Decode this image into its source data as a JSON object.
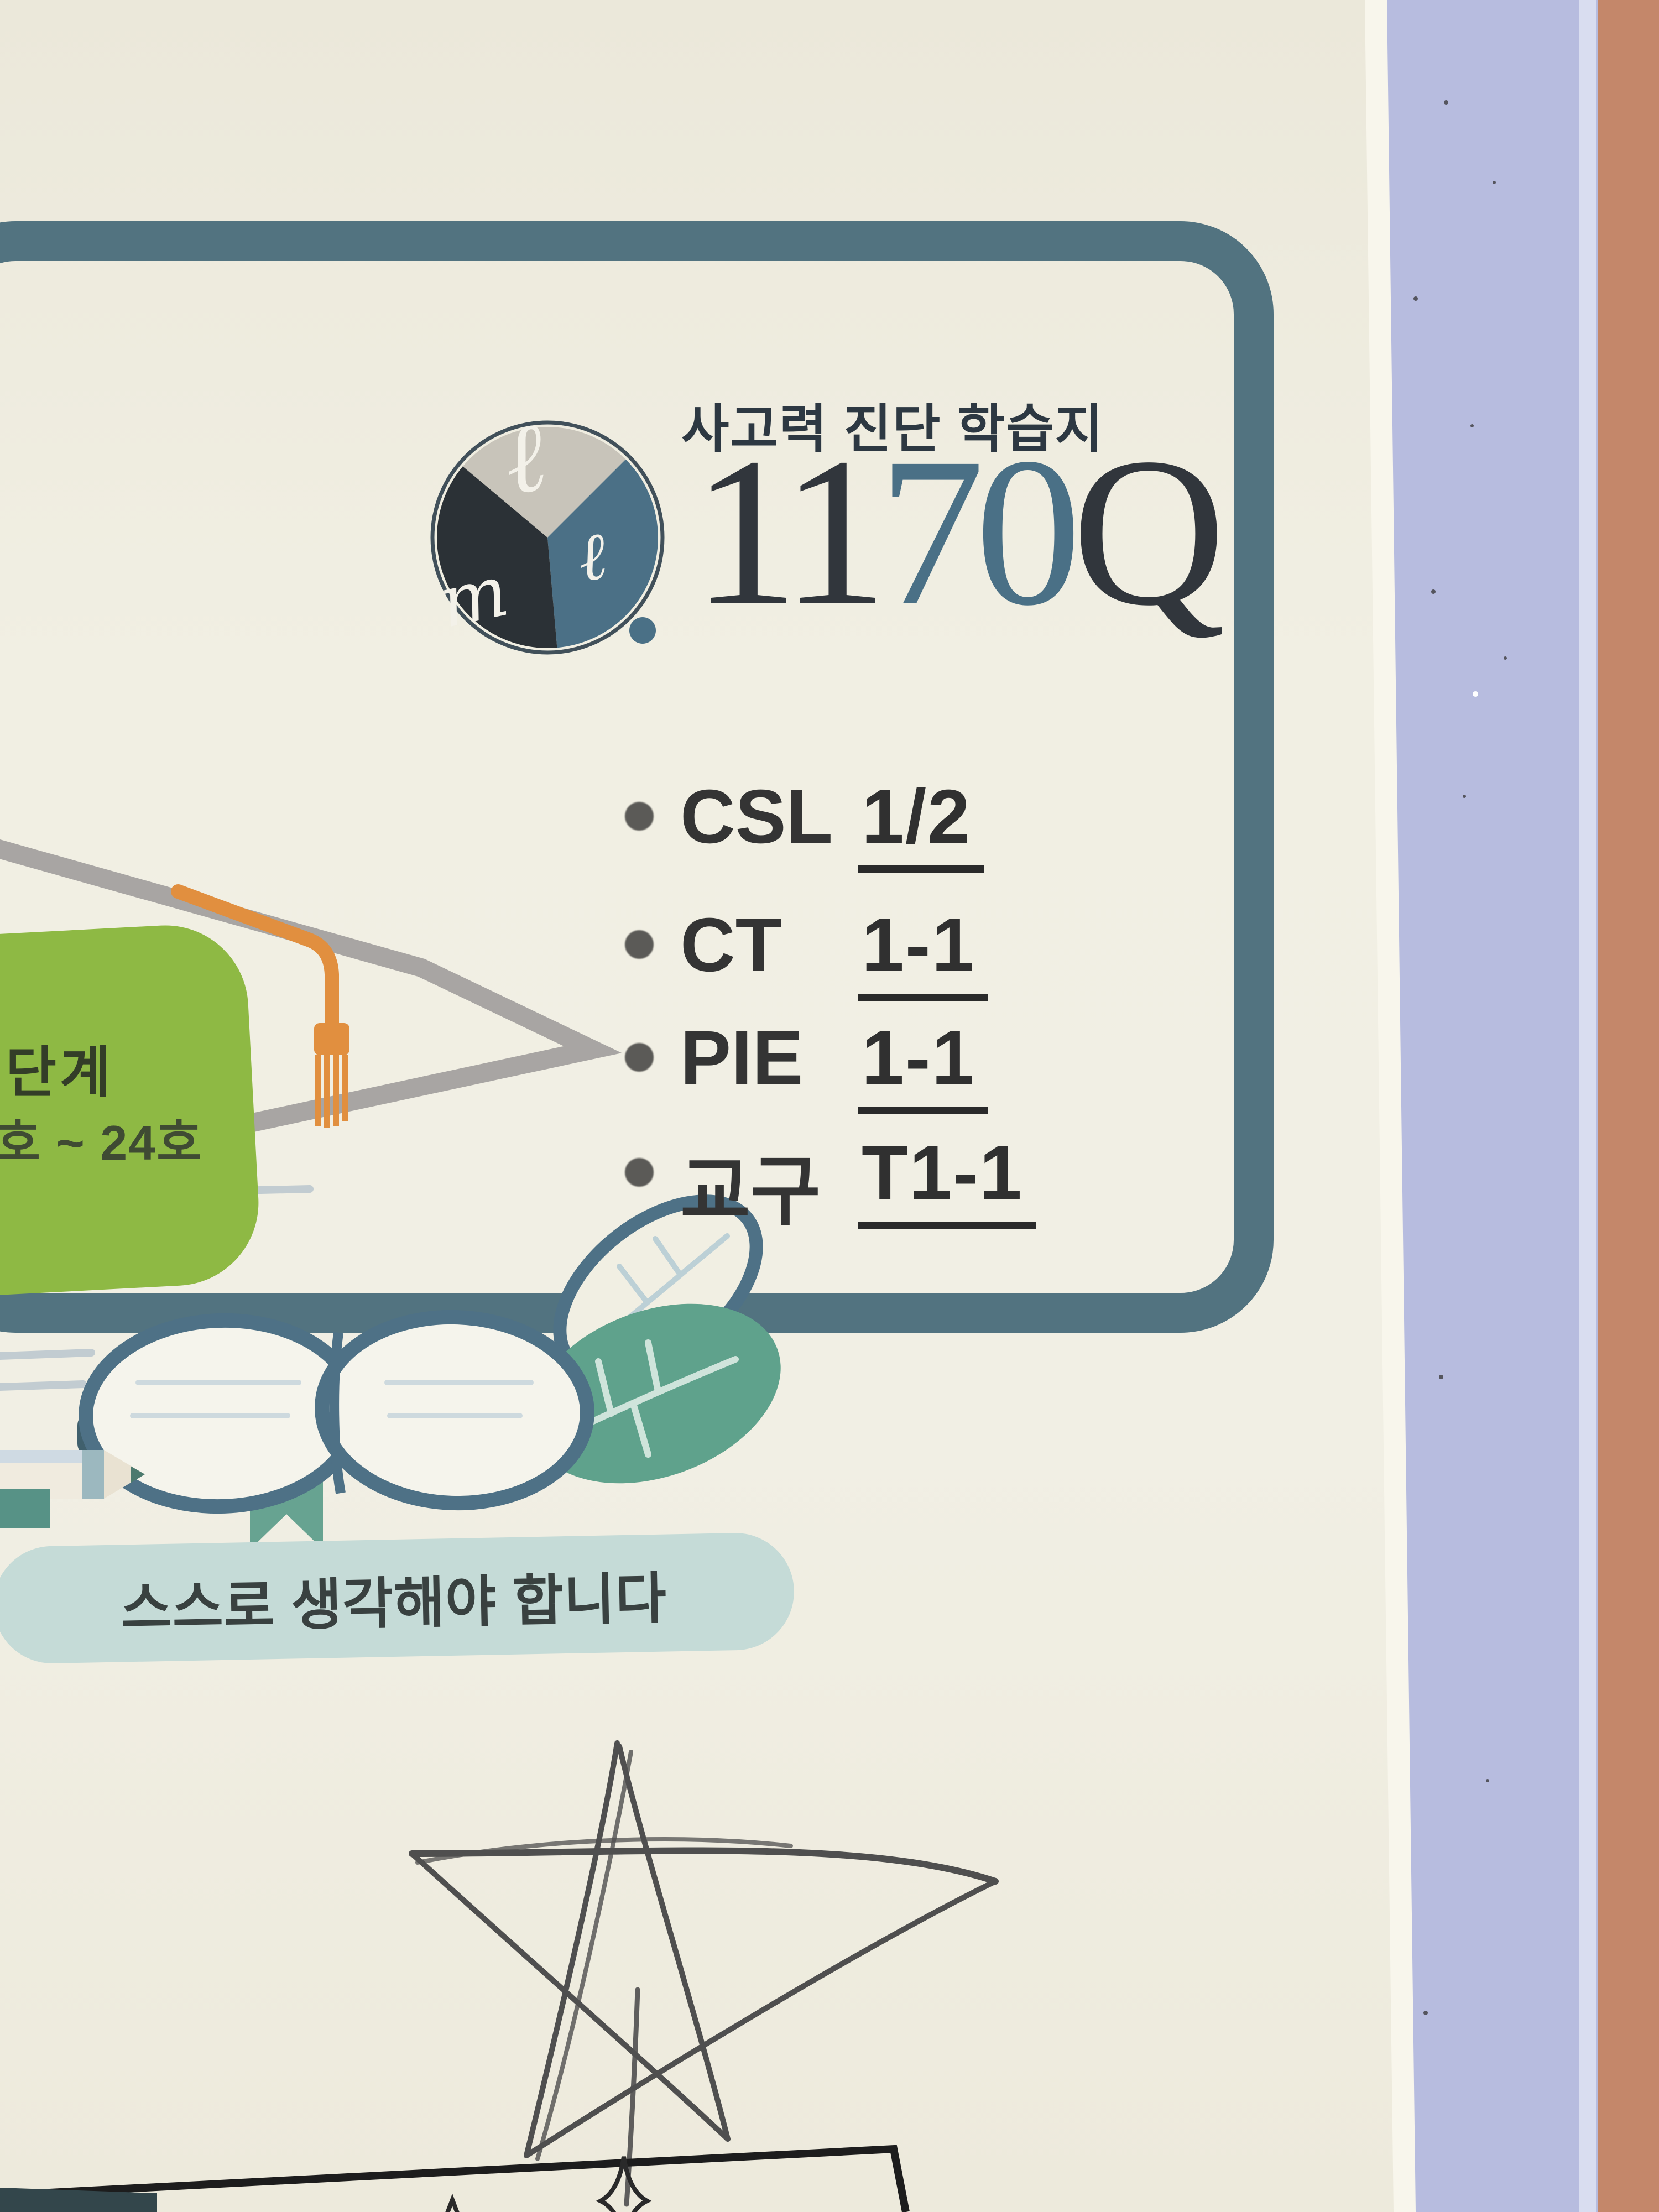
{
  "page": {
    "brand": {
      "subtitle": "사고력 진단 학습지",
      "title_part1": "11",
      "title_part2": "70",
      "title_part3": "Q",
      "logo_mark_top": "ℓ",
      "logo_mark_right": "ℓ",
      "logo_mark_bottom": "m"
    },
    "info_list": {
      "items": [
        {
          "label": "CSL",
          "value": "1/2"
        },
        {
          "label": "CT",
          "value": "1-1"
        },
        {
          "label": "PIE",
          "value": "1-1"
        },
        {
          "label": "교구",
          "value": "T1-1"
        }
      ]
    },
    "level_badge": {
      "line1": "단계",
      "line2": "호 ~ 24호"
    },
    "banner": {
      "text": "스스로 생각해야 합니다"
    },
    "colors": {
      "paper": "#f0eee2",
      "frame": "#527380",
      "accent_blue": "#4a7086",
      "title_dark": "#31363c",
      "badge_green": "#8eb944",
      "banner_mint": "#c5dbd7",
      "tassel_orange": "#e18f3f",
      "leaf_teal": "#5fa28c",
      "folder_lavender": "#b7bcdf",
      "desk_salmon": "#c4876a",
      "pencil_stroke": "#4f4f4f"
    }
  }
}
